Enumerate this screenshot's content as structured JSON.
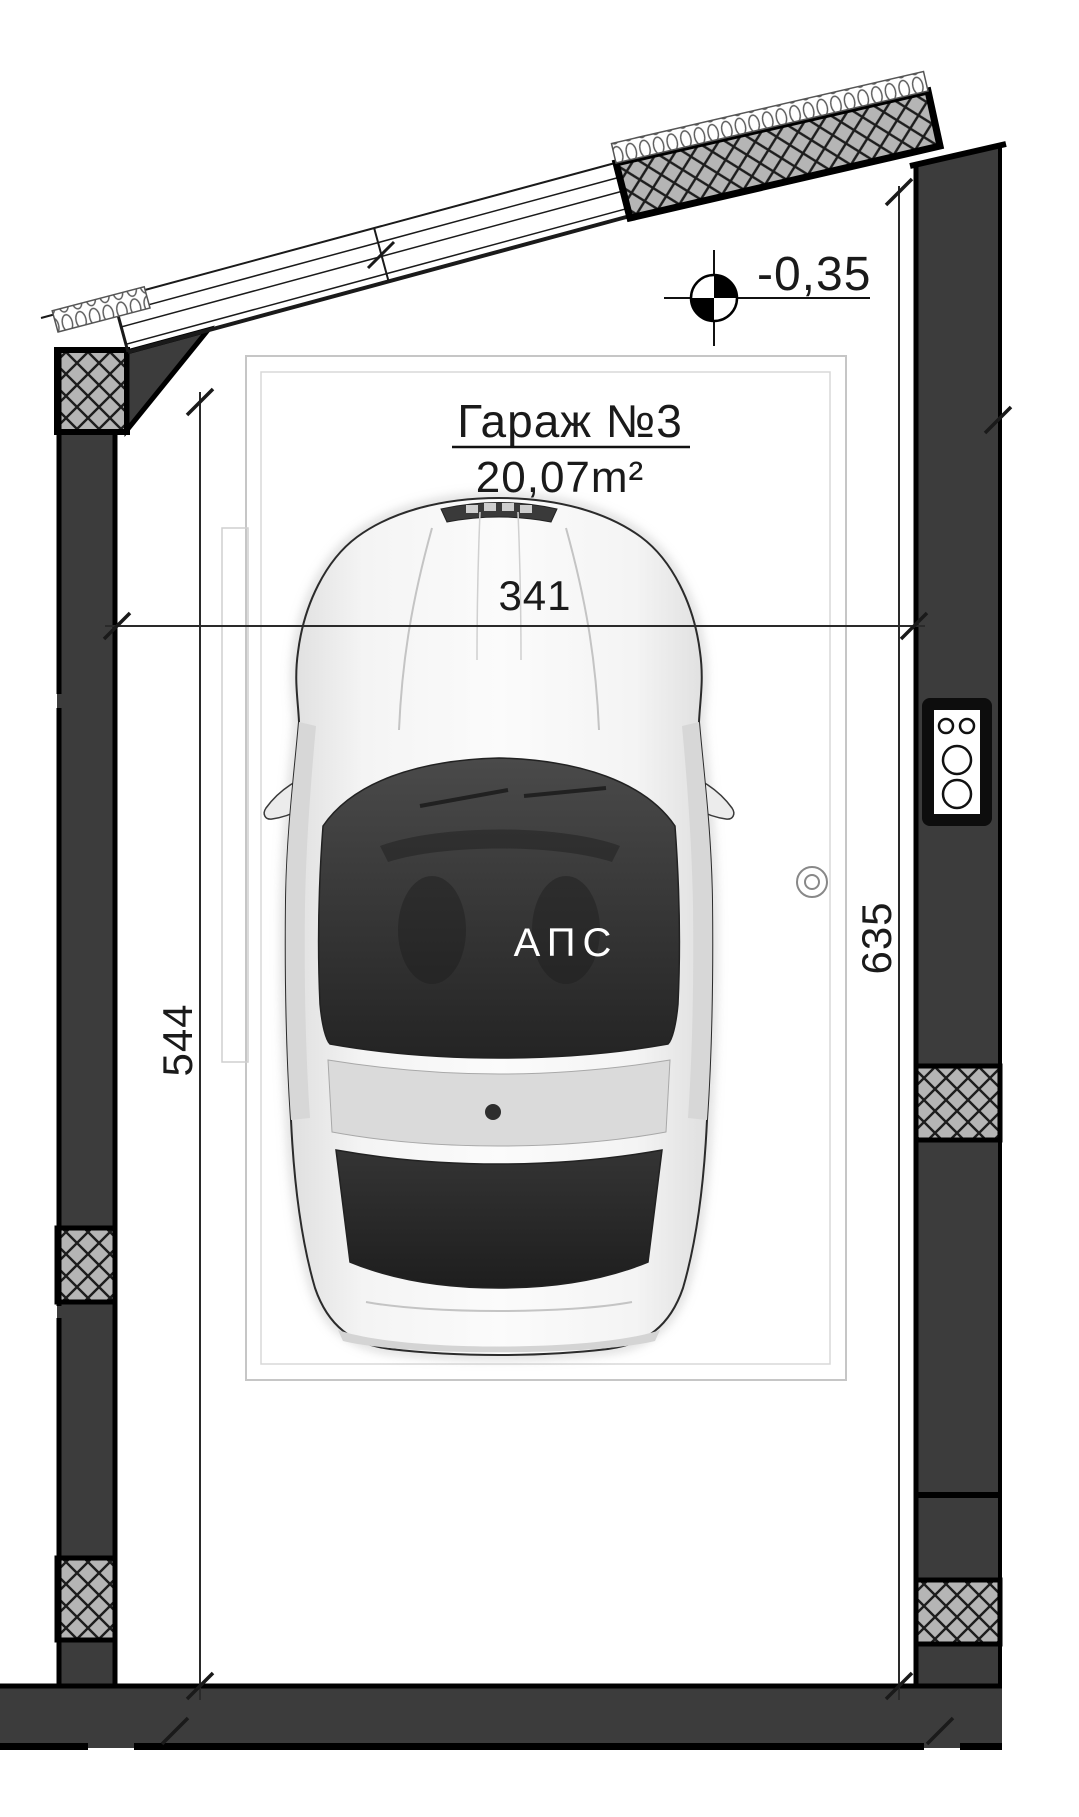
{
  "drawing": {
    "type": "garage-floor-plan",
    "room": {
      "title": "Гараж №3",
      "area": "20,07m²",
      "fire_system_label": "АПС"
    },
    "level_marker": {
      "value": "-0,35"
    },
    "dimensions": {
      "width": "341",
      "left_depth": "544",
      "right_depth": "635"
    },
    "colors": {
      "paper": "#ffffff",
      "wall_fill": "#3c3c3c",
      "hatch_fill": "#b5b5b5",
      "line": "#1a1a1a",
      "glass": "#3a3a3a",
      "car_body": "#f0f0f0",
      "parking_outline": "#c6c6c6"
    }
  }
}
